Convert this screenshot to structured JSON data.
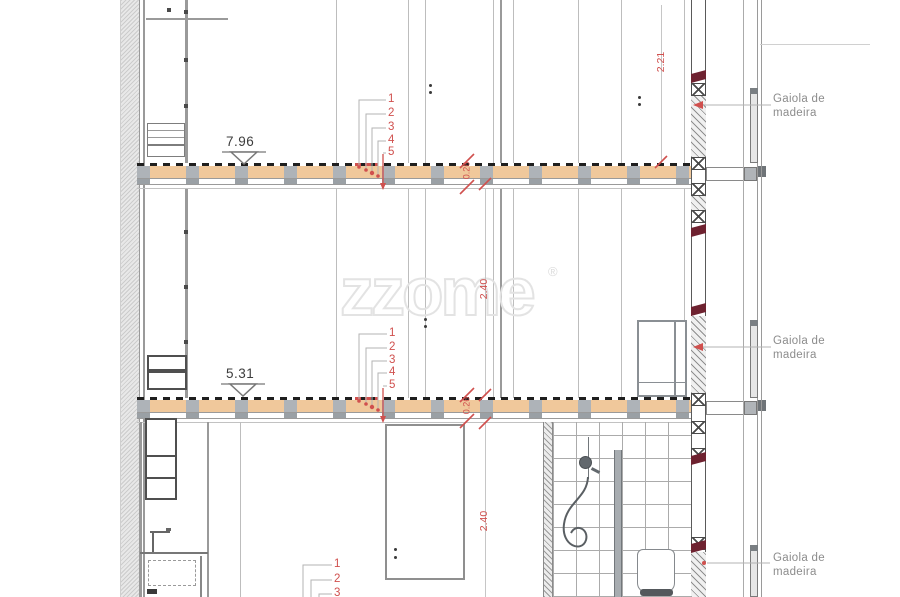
{
  "drawing": {
    "type": "architectural-section",
    "watermark": {
      "text": "zzome",
      "registered": "®"
    },
    "gaiola_label": {
      "line1": "Gaiola de",
      "line2": "madeira"
    },
    "levels": {
      "upper": "7.96",
      "lower": "5.31"
    },
    "dimensions": {
      "right_wall_height": "2.21",
      "middle_room_height": "2.40",
      "bottom_room_height": "2.40",
      "upper_slab_thickness": "0.26",
      "lower_slab_thickness": "0.26"
    },
    "layer_callouts": {
      "upper_floor": [
        "1",
        "2",
        "3",
        "4",
        "5"
      ],
      "lower_floor": [
        "1",
        "2",
        "3",
        "4",
        "5"
      ],
      "bottom": [
        "1",
        "2",
        "3"
      ]
    },
    "colors": {
      "dimension_red": "#d0504e",
      "wood_tan": "#f0c89b",
      "timber_maroon": "#6e2230",
      "label_gray": "#8c8c8c"
    }
  }
}
